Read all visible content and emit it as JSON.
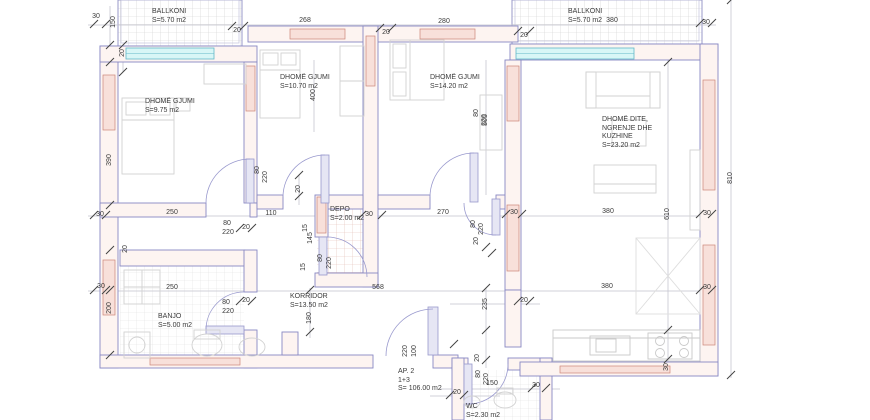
{
  "rooms": {
    "ballkoni_left": {
      "name": "BALLKONI",
      "area": "S=5.70 m2"
    },
    "gjumi_left": {
      "name": "DHOMË GJUMI",
      "area": "S=9.75 m2"
    },
    "gjumi_mid": {
      "name": "DHOMË GJUMI",
      "area": "S=10.70 m2"
    },
    "gjumi_right": {
      "name": "DHOMË GJUMI",
      "area": "S=14.20 m2"
    },
    "ballkoni_right": {
      "name": "BALLKONI",
      "area": "S=5.70 m2"
    },
    "dite": {
      "name": "DHOMË DITE,",
      "name2": "NGRENJE DHE",
      "name3": "KUZHINE",
      "area": "S=23.20 m2"
    },
    "depo": {
      "name": "DEPO",
      "area": "S=2.00 m2"
    },
    "korridor": {
      "name": "KORRIDOR",
      "area": "S=13.50 m2"
    },
    "banjo": {
      "name": "BANJO",
      "area": "S=5.00 m2"
    },
    "wc": {
      "name": "WC",
      "area": "S=2.30 m2"
    }
  },
  "apartment": {
    "label": "AP. 2",
    "layout_code": "1+3",
    "area": "S= 106.00 m2"
  },
  "colors": {
    "wall_line": "#8888c4",
    "wall_core": "#cc8578",
    "window": "#62b8c8",
    "text": "#3b3b3b"
  },
  "dims": [
    {
      "t": "30",
      "x": 96,
      "y": 17
    },
    {
      "t": "150",
      "x": 114,
      "y": 22,
      "r": 1
    },
    {
      "t": "20",
      "x": 123,
      "y": 53,
      "r": 1
    },
    {
      "t": "20",
      "x": 237,
      "y": 31
    },
    {
      "t": "268",
      "x": 305,
      "y": 21
    },
    {
      "t": "20",
      "x": 386,
      "y": 33
    },
    {
      "t": "280",
      "x": 444,
      "y": 22
    },
    {
      "t": "20",
      "x": 524,
      "y": 36
    },
    {
      "t": "380",
      "x": 612,
      "y": 21
    },
    {
      "t": "30",
      "x": 706,
      "y": 23
    },
    {
      "t": "390",
      "x": 110,
      "y": 160,
      "r": 1
    },
    {
      "t": "400",
      "x": 314,
      "y": 95,
      "r": 1
    },
    {
      "t": "505",
      "x": 486,
      "y": 120,
      "r": 1
    },
    {
      "t": "810",
      "x": 731,
      "y": 178,
      "r": 1
    },
    {
      "t": "610",
      "x": 668,
      "y": 214,
      "r": 1
    },
    {
      "t": "80",
      "x": 258,
      "y": 170,
      "r": 1
    },
    {
      "t": "220",
      "x": 266,
      "y": 177,
      "r": 1
    },
    {
      "t": "80",
      "x": 477,
      "y": 113,
      "r": 1
    },
    {
      "t": "220",
      "x": 485,
      "y": 120,
      "r": 1
    },
    {
      "t": "20",
      "x": 299,
      "y": 189,
      "r": 1
    },
    {
      "t": "30",
      "x": 100,
      "y": 215
    },
    {
      "t": "250",
      "x": 172,
      "y": 213
    },
    {
      "t": "110",
      "x": 271,
      "y": 214
    },
    {
      "t": "80",
      "x": 227,
      "y": 224
    },
    {
      "t": "220",
      "x": 228,
      "y": 233
    },
    {
      "t": "20",
      "x": 246,
      "y": 228
    },
    {
      "t": "30",
      "x": 369,
      "y": 215
    },
    {
      "t": "270",
      "x": 443,
      "y": 213
    },
    {
      "t": "30",
      "x": 514,
      "y": 213
    },
    {
      "t": "380",
      "x": 608,
      "y": 212
    },
    {
      "t": "30",
      "x": 707,
      "y": 214
    },
    {
      "t": "15",
      "x": 306,
      "y": 228,
      "r": 1
    },
    {
      "t": "145",
      "x": 311,
      "y": 238,
      "r": 1
    },
    {
      "t": "15",
      "x": 304,
      "y": 267,
      "r": 1
    },
    {
      "t": "80",
      "x": 321,
      "y": 258,
      "r": 1
    },
    {
      "t": "220",
      "x": 330,
      "y": 263,
      "r": 1
    },
    {
      "t": "80",
      "x": 474,
      "y": 224,
      "r": 1
    },
    {
      "t": "220",
      "x": 482,
      "y": 229,
      "r": 1
    },
    {
      "t": "20",
      "x": 477,
      "y": 241,
      "r": 1
    },
    {
      "t": "20",
      "x": 126,
      "y": 249,
      "r": 1
    },
    {
      "t": "200",
      "x": 110,
      "y": 308,
      "r": 1
    },
    {
      "t": "30",
      "x": 101,
      "y": 287
    },
    {
      "t": "250",
      "x": 172,
      "y": 288
    },
    {
      "t": "80",
      "x": 226,
      "y": 303
    },
    {
      "t": "220",
      "x": 228,
      "y": 312
    },
    {
      "t": "20",
      "x": 246,
      "y": 301
    },
    {
      "t": "568",
      "x": 378,
      "y": 288
    },
    {
      "t": "180",
      "x": 310,
      "y": 318,
      "r": 1
    },
    {
      "t": "235",
      "x": 486,
      "y": 304,
      "r": 1
    },
    {
      "t": "20",
      "x": 524,
      "y": 301
    },
    {
      "t": "380",
      "x": 607,
      "y": 287
    },
    {
      "t": "30",
      "x": 707,
      "y": 288
    },
    {
      "t": "220",
      "x": 406,
      "y": 351,
      "r": 1
    },
    {
      "t": "100",
      "x": 415,
      "y": 351,
      "r": 1
    },
    {
      "t": "20",
      "x": 457,
      "y": 393
    },
    {
      "t": "20",
      "x": 478,
      "y": 358,
      "r": 1
    },
    {
      "t": "80",
      "x": 479,
      "y": 374,
      "r": 1
    },
    {
      "t": "220",
      "x": 487,
      "y": 379,
      "r": 1
    },
    {
      "t": "150",
      "x": 492,
      "y": 384
    },
    {
      "t": "30",
      "x": 536,
      "y": 386
    },
    {
      "t": "30",
      "x": 667,
      "y": 367,
      "r": 1
    }
  ]
}
